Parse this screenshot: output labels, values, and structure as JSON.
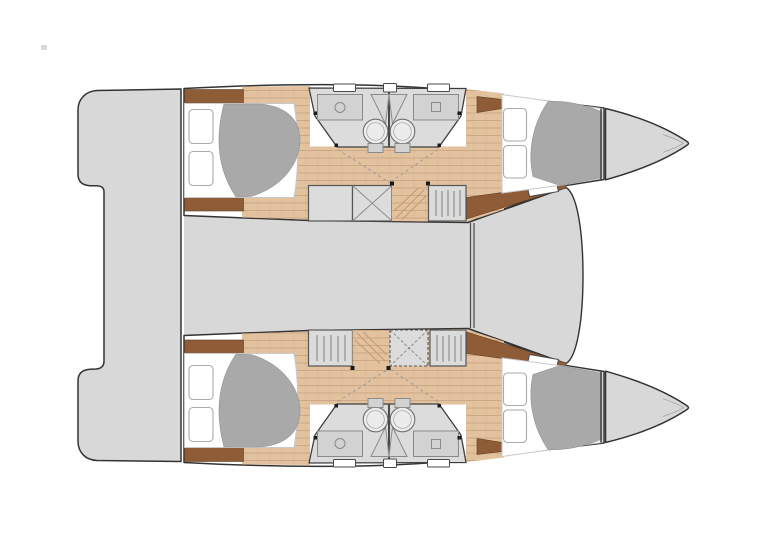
{
  "document": {
    "subject": "catamaran-deck-plan",
    "orientation": "bow-right-stern-left",
    "visible_text": ""
  },
  "colors": {
    "background": "#ffffff",
    "deck": "#d8d8d8",
    "hull-outline": "#333333",
    "wood-floor": "#e3c2a0",
    "wood-seam": "#c9a27c",
    "wood-trim": "#8e5c36",
    "bathroom": "#dcdcdc",
    "fixture": "#d2d2d2",
    "fixture-line": "#8a8a8a",
    "duvet": "#a9a9a9",
    "bed": "#ffffff",
    "pillow-line": "#aaaaaa",
    "locker": "#dcdcdc",
    "locker-line": "#555555",
    "watermark": "#d9d9d9"
  },
  "plan": {
    "center_structures": [
      "transom-platforms",
      "aft-cockpit",
      "saloon-bridge-deck",
      "foredeck"
    ],
    "hulls": [
      {
        "name": "port-hull-top",
        "spaces": [
          "aft-double-berth",
          "bathroom-pair",
          "corridor",
          "forward-double-berth",
          "bow-locker"
        ],
        "wardrobes": [
          "wardrobe-plain",
          "wardrobe-cross",
          "companionway-stairs",
          "hanging-locker"
        ],
        "fixtures": {
          "toilets": 2,
          "washbasins": 2,
          "deck-hatches": 3,
          "pillows": 4
        }
      },
      {
        "name": "starboard-hull-bottom",
        "spaces": [
          "aft-double-berth",
          "bathroom-pair",
          "corridor",
          "forward-double-berth",
          "bow-locker"
        ],
        "wardrobes": [
          "hanging-locker",
          "companionway-stairs",
          "wardrobe-cross-dashed",
          "hanging-locker"
        ],
        "fixtures": {
          "toilets": 2,
          "washbasins": 2,
          "deck-hatches": 3,
          "pillows": 4
        }
      }
    ],
    "counts": {
      "cabins": 4,
      "bathrooms": 4,
      "bows": 2,
      "berths": 4
    }
  }
}
